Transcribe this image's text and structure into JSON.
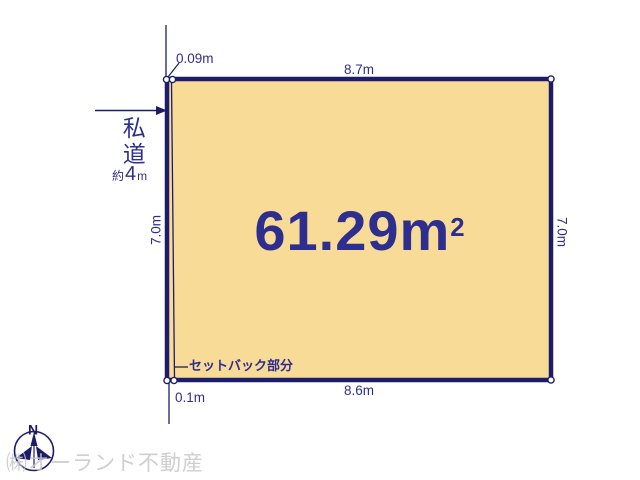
{
  "diagram": {
    "area": {
      "value": "61.29",
      "unit": "m",
      "exponent": "2"
    },
    "dimensions": {
      "top": "8.7m",
      "bottom": "8.6m",
      "left": "7.0m",
      "right": "7.0m",
      "setback_top": "0.09m",
      "setback_bottom": "0.1m"
    },
    "setback_label": "セットバック部分",
    "road": {
      "name": "私道",
      "width_prefix": "約",
      "width_value": "4",
      "width_unit": "m"
    },
    "compass": {
      "north": "N"
    },
    "watermark": "㈱オーランド不動産",
    "colors": {
      "plot_fill": "#f8db97",
      "line_navy": "#1c1c6b",
      "text_navy": "#2e2e8f",
      "watermark_gray": "#c7c7c7"
    }
  }
}
